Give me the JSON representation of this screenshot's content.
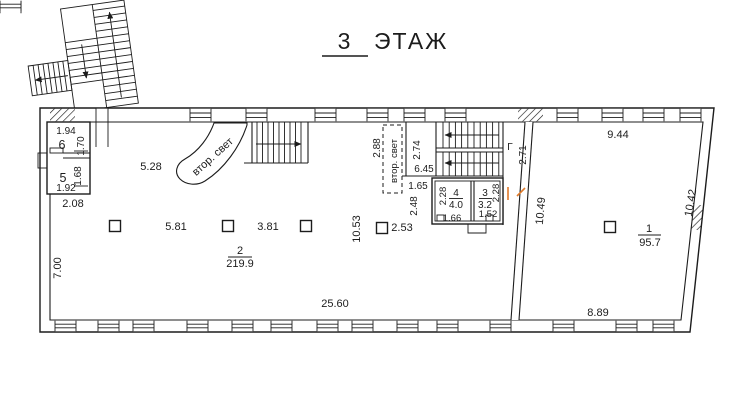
{
  "title": {
    "number": "3",
    "label": "ЭТАЖ"
  },
  "rooms": {
    "r1": {
      "number": "1",
      "area": "95.7"
    },
    "r2": {
      "number": "2",
      "area": "219.9"
    },
    "r3": {
      "number": "3",
      "area": "3.2",
      "width": "1.52",
      "height": "2.28"
    },
    "r4": {
      "number": "4",
      "area": "4.0",
      "width": "1.66",
      "height": "2.28"
    },
    "r5": {
      "number": "5",
      "width": "1.92",
      "height": "1.68"
    },
    "r6": {
      "number": "6",
      "width": "1.94",
      "height": "1.70"
    }
  },
  "dims": {
    "left_block_width": "2.08",
    "left_wall": "7.00",
    "hall_left": "5.28",
    "col_span_1": "5.81",
    "col_span_2": "3.81",
    "col_span_3": "2.53",
    "hall_depth": "10.53",
    "hall_width": "25.60",
    "shaft_width": "2.88",
    "stair_width": "2.74",
    "stair_length": "6.45",
    "landing": "1.65",
    "corridor": "2.48",
    "stair_exit": "2.71",
    "room1_top": "9.44",
    "room1_left": "10.49",
    "room1_right": "10.42",
    "room1_bottom": "8.89"
  },
  "annotations": {
    "second_light_curved": "втор. свет",
    "second_light_shaft": "втор. свет",
    "gamma": "Г"
  },
  "colors": {
    "ink": "#1c1c1c",
    "accent_door": "#e07a2a",
    "background": "#ffffff"
  }
}
